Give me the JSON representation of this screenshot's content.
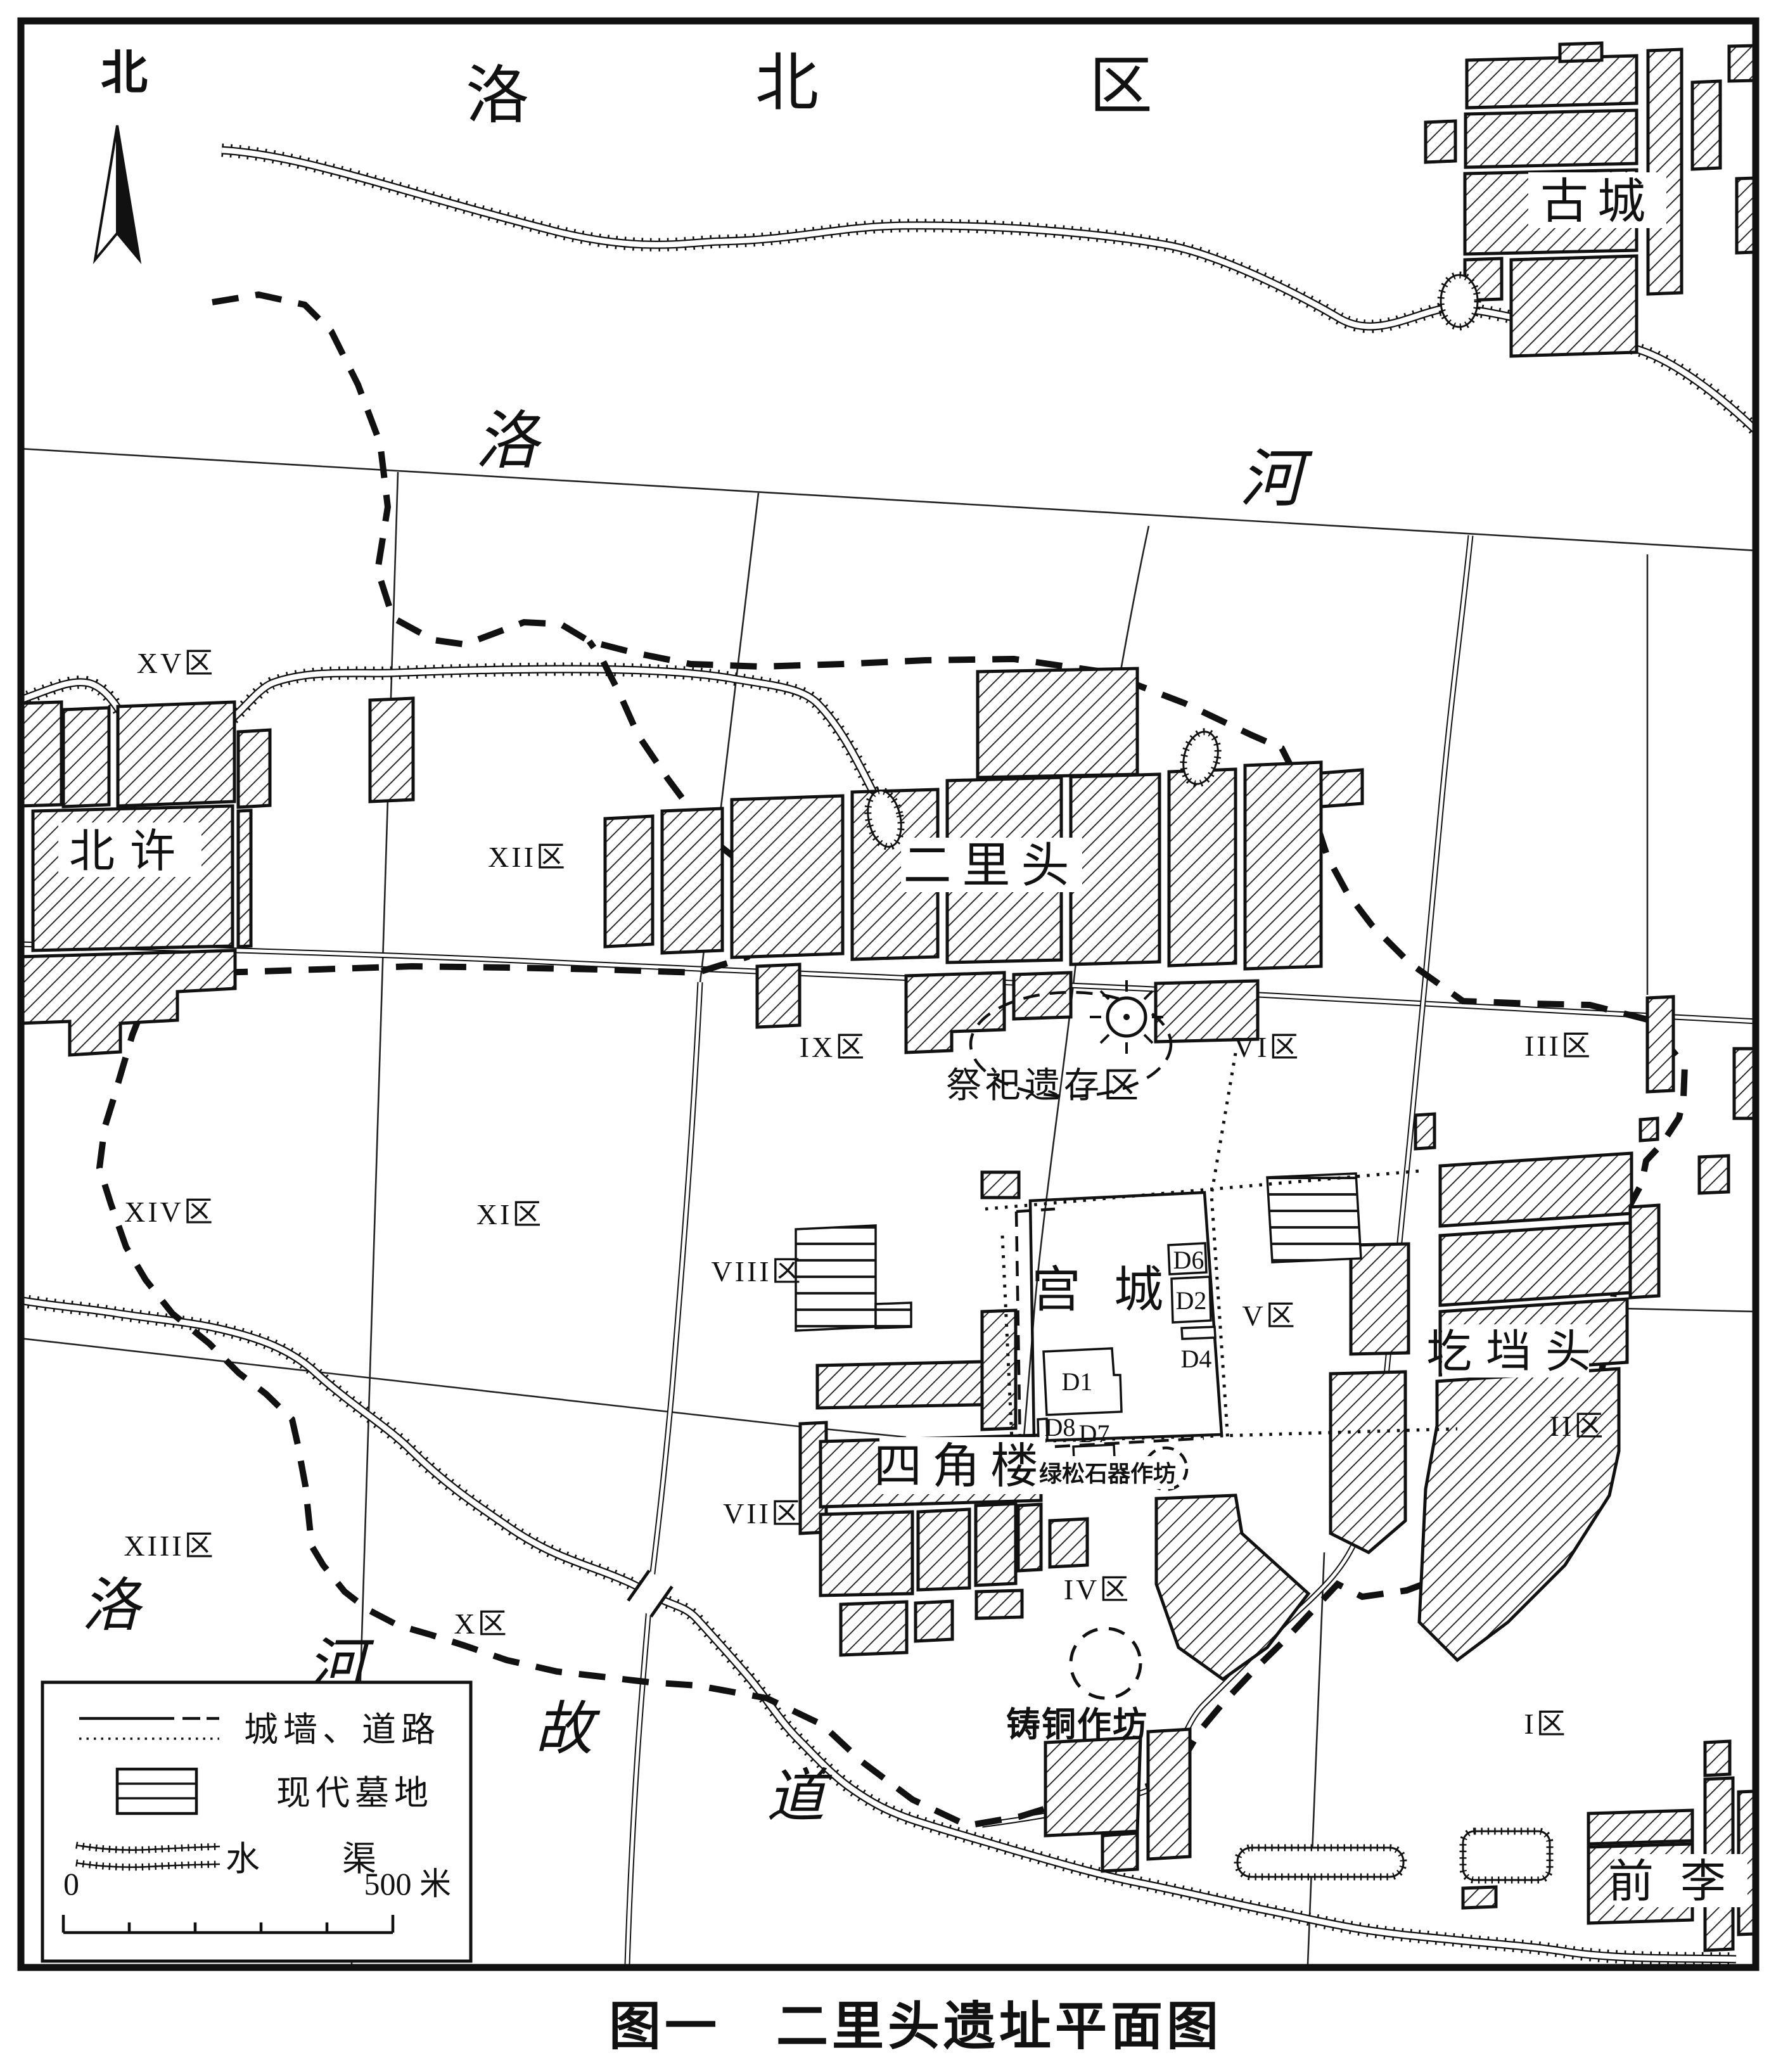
{
  "figure": {
    "title": "图一　二里头遗址平面图"
  },
  "compass": {
    "north_label": "北"
  },
  "district_banner": {
    "chars": [
      "洛",
      "北",
      "区"
    ]
  },
  "rivers": {
    "luo": [
      "洛",
      "河"
    ],
    "old_course": [
      "洛",
      "河",
      "故",
      "道"
    ]
  },
  "villages": {
    "gucheng": "古城",
    "beixu": "北许",
    "erlitou": "二里头",
    "gedangtou": "圪垱头",
    "sijiaolou": "四角楼",
    "qianli": "前李"
  },
  "zones": [
    {
      "id": "XV",
      "label": "XV区"
    },
    {
      "id": "XII",
      "label": "XII区"
    },
    {
      "id": "IX",
      "label": "IX区"
    },
    {
      "id": "VI",
      "label": "VI区"
    },
    {
      "id": "III",
      "label": "III区"
    },
    {
      "id": "XIV",
      "label": "XIV区"
    },
    {
      "id": "XI",
      "label": "XI区"
    },
    {
      "id": "VIII",
      "label": "VIII区"
    },
    {
      "id": "V",
      "label": "V区"
    },
    {
      "id": "II",
      "label": "II区"
    },
    {
      "id": "VII",
      "label": "VII区"
    },
    {
      "id": "X",
      "label": "X区"
    },
    {
      "id": "XIII",
      "label": "XIII区"
    },
    {
      "id": "IV",
      "label": "IV区"
    },
    {
      "id": "I",
      "label": "I区"
    }
  ],
  "features": {
    "sacrificial_area": "祭祀遗存区",
    "palace_city": "宫城",
    "turquoise_workshop": "绿松石器作坊",
    "bronze_workshop": "铸铜作坊",
    "buildings": [
      "D6",
      "D2",
      "D4",
      "D1",
      "D8",
      "D7"
    ]
  },
  "legend": {
    "wall_road": "城墙、道路",
    "cemetery": "现代墓地",
    "canal": "水渠",
    "scale_zero": "0",
    "scale_end": "500 米"
  }
}
